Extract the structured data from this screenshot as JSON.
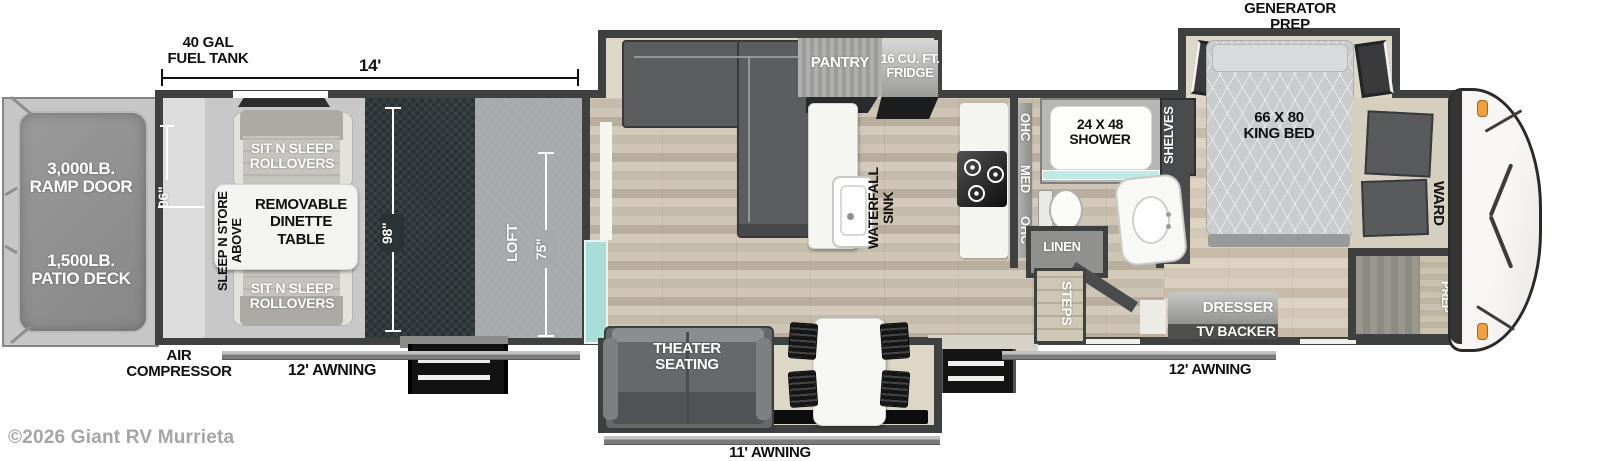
{
  "watermark": "©2026 Giant RV Murrieta",
  "colors": {
    "wall": "#3f4040",
    "wood_floor": "#cdc3b4",
    "garage_dark_floor": "#2c3337",
    "loft_gray": "#a6aaac",
    "teal_glass": "#a9ddd7",
    "marker_light_orange": "#f0a03c",
    "sofa_gray": "#5b5d5f"
  },
  "labels": {
    "fuel_tank": "40 GAL\nFUEL TANK",
    "dim_14": "14'",
    "ramp_door": "3,000LB.\nRAMP DOOR",
    "patio_deck": "1,500LB.\nPATIO DECK",
    "dim_96": "96\"",
    "sit_n_sleep_top": "SIT N SLEEP\nROLLOVERS",
    "sleep_n_store": "SLEEP N STORE\nABOVE",
    "removable_dinette": "REMOVABLE\nDINETTE\nTABLE",
    "sit_n_sleep_bottom": "SIT N SLEEP\nROLLOVERS",
    "dim_98": "98\"",
    "loft": "LOFT",
    "dim_75": "75\"",
    "air_compressor": "AIR\nCOMPRESSOR",
    "awning_left": "12' AWNING",
    "pantry": "PANTRY",
    "fridge": "16 CU. FT.\nFRIDGE",
    "waterfall_sink": "WATERFALL\nSINK",
    "ohc_top": "OHC",
    "med": "MED",
    "ohc_bottom": "OHC",
    "theater_seating": "THEATER\nSEATING",
    "awning_center": "11' AWNING",
    "shower": "24 X 48\nSHOWER",
    "linen": "LINEN",
    "steps": "STEPS",
    "shelves": "SHELVES",
    "generator_prep": "GENERATOR\nPREP",
    "king_bed": "66 X 80\nKING BED",
    "ward": "WARD",
    "washer_dryer_prep": "WASHER/\nDRYER\nPREP",
    "dresser": "DRESSER",
    "tv_backer": "TV BACKER",
    "awning_right": "12' AWNING"
  }
}
